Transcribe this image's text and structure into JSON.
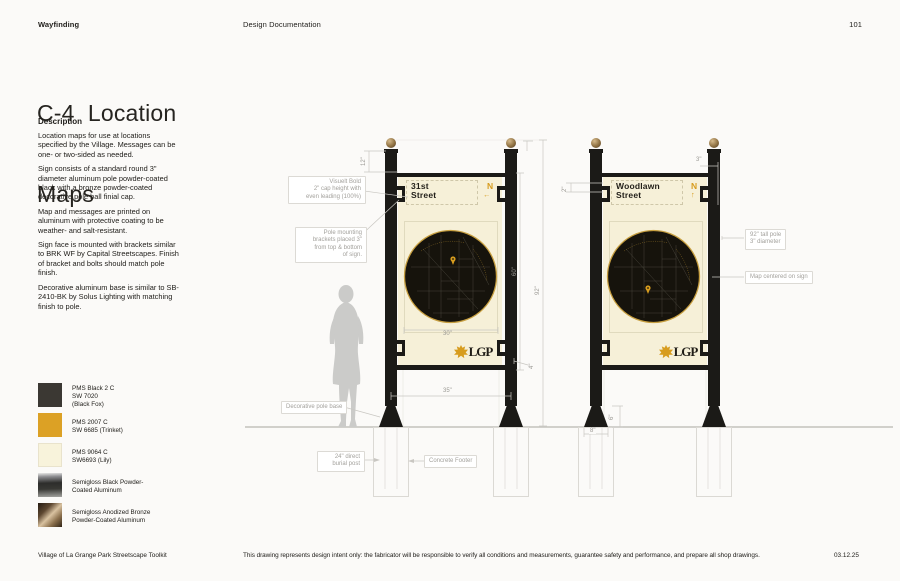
{
  "header": {
    "section": "Wayfinding",
    "doc": "Design Documentation",
    "page": "101"
  },
  "title": {
    "line1": "C-4  Location",
    "line2": "Maps"
  },
  "description": {
    "heading": "Description",
    "p1": "Location maps for use at locations specified by the Village. Messages can be one- or two-sided as needed.",
    "p2": "Sign consists of a standard round 3\" diameter aluminum pole powder-coated black with a bronze powder-coated decorative pole ball finial cap.",
    "p3": "Map and messages are printed on aluminum with protective coating to be weather- and salt-resistant.",
    "p4": "Sign face is mounted with brackets similar to BRK WF by Capital Streetscapes. Finish of bracket and bolts should match pole finish.",
    "p5": "Decorative aluminum base is similar to SB-2410-BK by Solus Lighting with matching finish to pole."
  },
  "swatches": [
    {
      "l1": "PMS Black 2 C",
      "l2": "SW 7020",
      "l3": "(Black Fox)",
      "color": "#3B3833"
    },
    {
      "l1": "PMS 2007 C",
      "l2": "SW 6685 (Trinket)",
      "l3": "",
      "color": "#DCA125"
    },
    {
      "l1": "PMS 9064 C",
      "l2": "SW6693 (Lily)",
      "l3": "",
      "color": "#F8F3DB"
    },
    {
      "l1": "Semigloss Black Powder-",
      "l2": "Coated Aluminum",
      "l3": "",
      "color": "metallic-black"
    },
    {
      "l1": "Semigloss Anodized Bronze",
      "l2": "Powder-Coated Aluminum",
      "l3": "",
      "color": "metallic-bronze"
    }
  ],
  "signs": [
    {
      "line1": "31st",
      "line2": "Street",
      "north": "N",
      "arrow": "←"
    },
    {
      "line1": "Woodlawn",
      "line2": "Street",
      "north": "N",
      "arrow": "↑"
    }
  ],
  "logo": {
    "text": "LGP"
  },
  "callouts": {
    "visuelt": {
      "l1": "Visuelt Bold",
      "l2": "2\" cap height with",
      "l3": "even leading (100%)"
    },
    "brackets": {
      "l1": "Pole mounting",
      "l2": "brackets placed 3\"",
      "l3": "from top & bottom",
      "l4": "of sign."
    },
    "pole": {
      "l1": "92\" tall pole",
      "l2": "3\" diameter"
    },
    "map_centered": {
      "l1": "Map centered on sign"
    },
    "base": {
      "l1": "Decorative pole base"
    },
    "burial": {
      "l1": "24\" direct",
      "l2": "burial post"
    },
    "footer_label": {
      "l1": "Concrete Footer"
    }
  },
  "dims": {
    "pole_top": "12\"",
    "cap": "2\"",
    "gap": "3\"",
    "sign_h": "60\"",
    "pole_h": "92\"",
    "map_w": "30\"",
    "sign_w": "35\"",
    "bracket": "4\"",
    "base_h": "6\"",
    "base_w": "8\""
  },
  "footer": {
    "left": "Village of La Grange Park Streetscape Toolkit",
    "center": "This drawing represents design intent only: the fabricator will be responsible to verify all conditions and measurements, guarantee safety and performance, and prepare all shop drawings.",
    "right": "03.12.25"
  },
  "colors": {
    "gold": "#D79C1E",
    "cream": "#F6F0D8",
    "ink": "#1E1C19",
    "pole_black": "#1B1A17",
    "bronze": "#A98A5B"
  }
}
